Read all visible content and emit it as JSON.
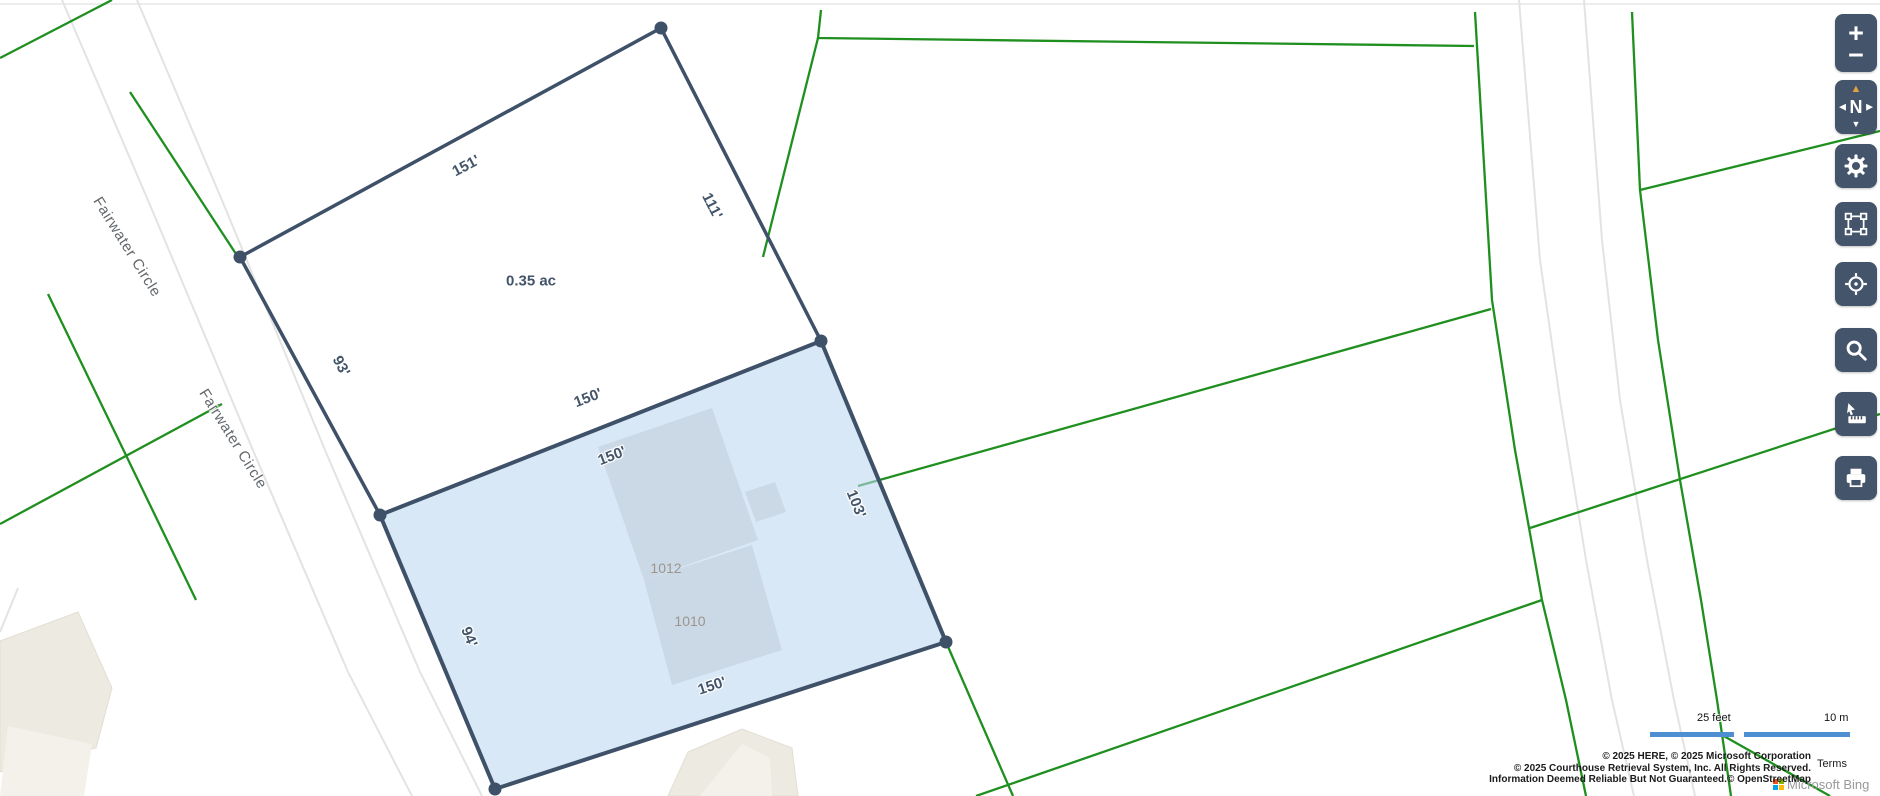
{
  "map": {
    "area_label": "0.35 ac",
    "dim_labels": [
      "151'",
      "111'",
      "93'",
      "150'",
      "150'",
      "103'",
      "94'",
      "150'"
    ],
    "parcel_numbers": [
      "1012",
      "1010"
    ],
    "street_labels": [
      "Fairwater Circle",
      "Fairwater Circle"
    ]
  },
  "toolbar": {
    "zoom_in": "+",
    "zoom_out": "−",
    "compass_north": "N",
    "compass_up": "▲",
    "compass_down": "▼",
    "compass_left": "◀",
    "compass_right": "▶",
    "icons": [
      "zoom-in",
      "zoom-out",
      "compass",
      "settings-gear",
      "extent-rectangle",
      "locate-crosshair",
      "search-magnifier",
      "measure-ruler",
      "print"
    ]
  },
  "scale": {
    "feet": "25 feet",
    "meters": "10 m"
  },
  "attribution": {
    "line1": "© 2025 HERE, © 2025 Microsoft Corporation",
    "line2": "© 2025 Courthouse Retrieval System, Inc. All Rights Reserved.",
    "line3": "Information Deemed Reliable But Not Guaranteed.© OpenStreetMap",
    "terms": "Terms",
    "watermark": "Microsoft Bing"
  },
  "colors": {
    "toolbar_bg": "#44546B",
    "parcel_outline": "#3E5168",
    "selected_parcel_fill": "#D6E7F6",
    "boundary_green": "#1F8F1F",
    "road_gray": "#E3E3E3",
    "scalebar_blue": "#4E8FD2",
    "compass_north_orange": "#E2A33B"
  }
}
